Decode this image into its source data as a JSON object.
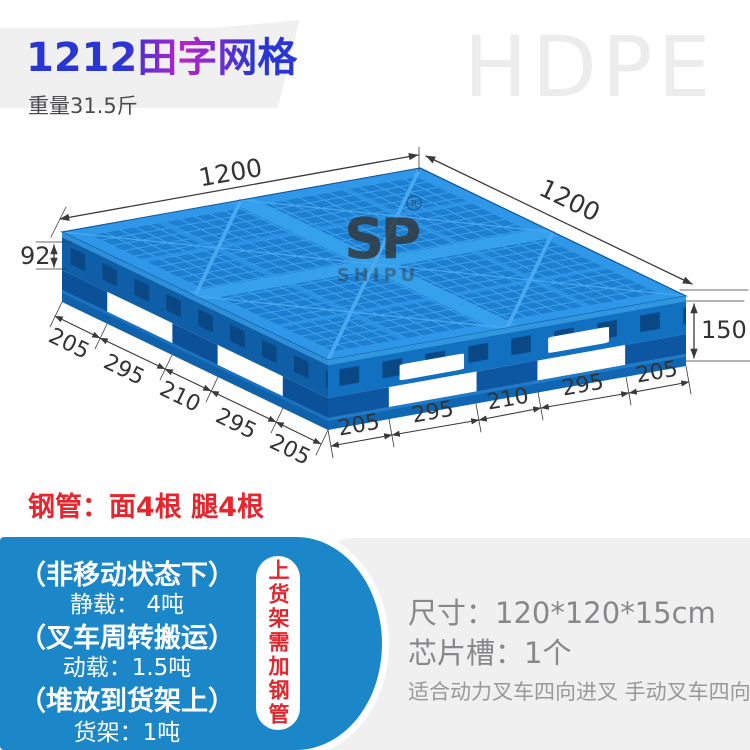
{
  "header": {
    "title": "1212田字网格",
    "weight": "重量31.5斤",
    "material": "HDPE"
  },
  "watermark": {
    "logo": "SP",
    "reg": "R",
    "brand": "SHIPU"
  },
  "pallet_dims": {
    "top_left": "1200",
    "top_right": "1200",
    "height_left": "92",
    "height_right": "150",
    "left_chain": [
      "205",
      "295",
      "210",
      "295",
      "205"
    ],
    "front_chain": [
      "205",
      "295",
      "210",
      "295",
      "205"
    ]
  },
  "steel_pipe_note": "钢管：面4根 腿4根",
  "load_box": {
    "static_label": "（非移动状态下）",
    "static_value": "静载： 4吨",
    "dynamic_label": "（叉车周转搬运）",
    "dynamic_value": "动载：1.5吨",
    "rack_label": "（堆放到货架上）",
    "rack_value": "货架：1吨",
    "side_note": "上货架需加钢管"
  },
  "specs": {
    "size": "尺寸：120*120*15cm",
    "chip_slot": "芯片槽：1个",
    "fork_note": "适合动力叉车四向进叉 手动叉车四向进叉"
  },
  "colors": {
    "pallet_blue": "#1d7fd0",
    "box_blue": "#1b87c8",
    "accent_red": "#e8242d",
    "title_blue": "#2936d3",
    "title_magenta": "#bb22cc",
    "hdpe_gray": "#ececec"
  }
}
